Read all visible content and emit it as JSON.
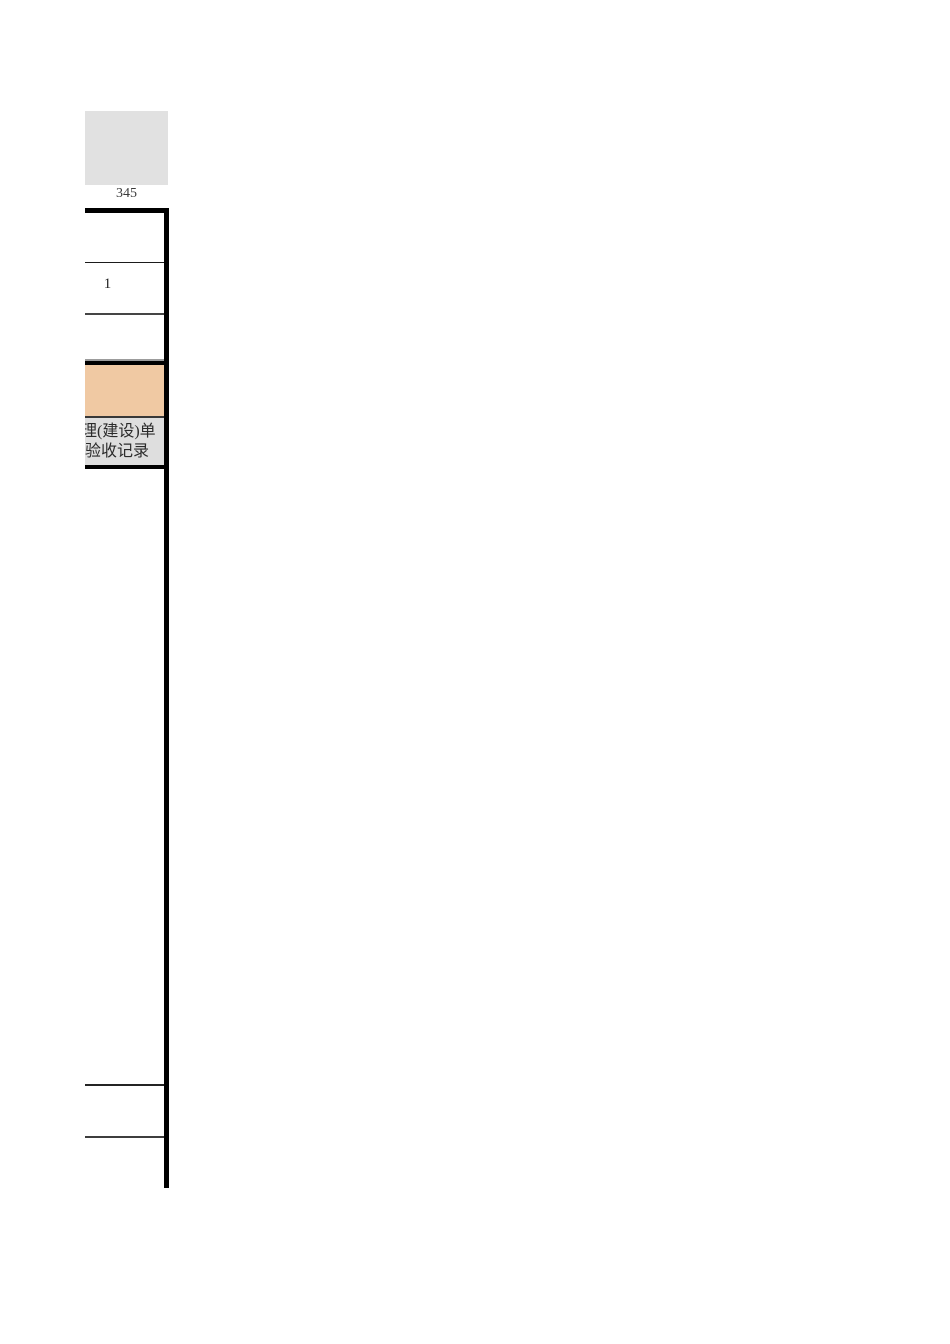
{
  "page": {
    "background": "#ffffff",
    "description_label": "clipped right edge of a spreadsheet acceptance-record table"
  },
  "colors": {
    "square_fill": "#e1e1e1",
    "orange_fill": "#f0c9a3",
    "gray_fill": "#dedede",
    "border_black": "#000000",
    "separator_dark": "#454545",
    "text": "#2b2b2b"
  },
  "header": {
    "square_label": "345"
  },
  "table": {
    "row2_value": "1",
    "gray_cell": {
      "line1": "理(建设)单",
      "line2": "验收记录"
    }
  }
}
